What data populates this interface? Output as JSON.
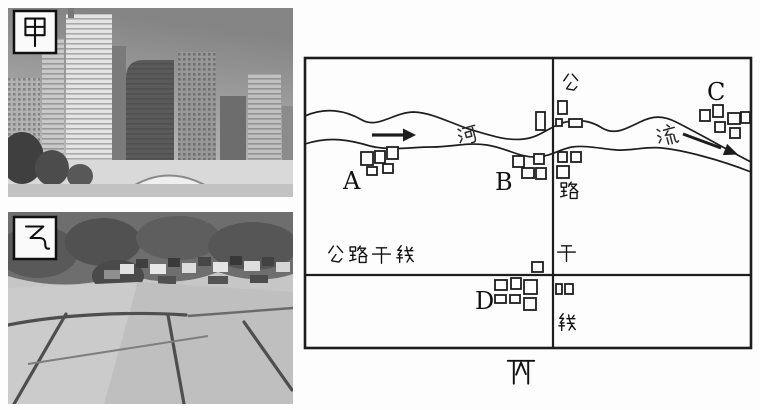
{
  "page": {
    "background": "#ffffff",
    "ink": "#1e1e1e"
  },
  "photos": {
    "jia": {
      "label": "甲",
      "alt": "urban scene: dense high-rise skyscraper skyline"
    },
    "yi": {
      "label": "乙",
      "alt": "rural scene: village houses with paddy fields"
    }
  },
  "map": {
    "caption": "丙",
    "river": {
      "name": "河流",
      "chars": [
        "河",
        "流"
      ],
      "flow_direction": "west to east"
    },
    "roads": {
      "vertical_label": "公路干线",
      "vertical_label_chars": [
        "公",
        "路",
        "干",
        "线"
      ],
      "horizontal_label": "公路干线"
    },
    "settlements": [
      {
        "id": "A",
        "position": "west, south bank of river"
      },
      {
        "id": "B",
        "position": "center, south bank near road crossing"
      },
      {
        "id": "C",
        "position": "east, north bank of river"
      },
      {
        "id": "D",
        "position": "south, at highway junction"
      }
    ],
    "colors": {
      "line": "#1e1e1e",
      "background": "#ffffff"
    }
  }
}
